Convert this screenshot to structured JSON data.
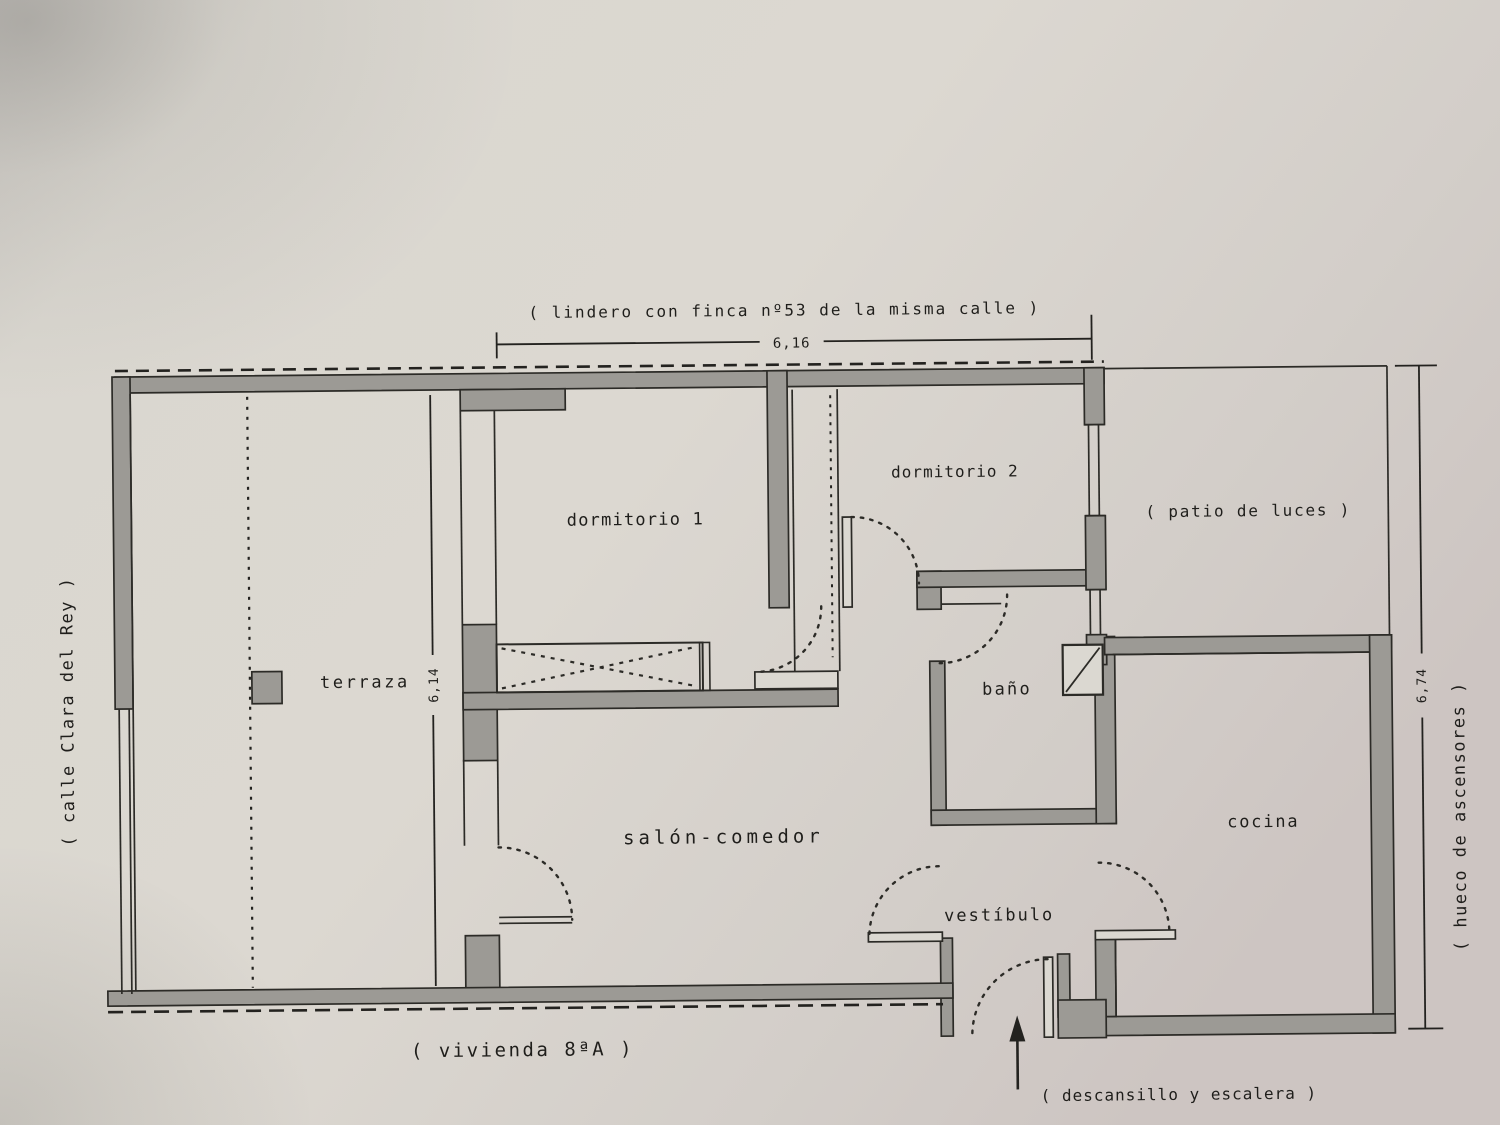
{
  "document_type": "scanned architectural floor plan",
  "labels": {
    "boundary_top": "( lindero con finca nº53 de la misma calle )",
    "street_left": "( calle Clara del Rey )",
    "patio": "( patio de luces )",
    "elevator_shaft": "( hueco de ascensores )",
    "dwelling": "( vivienda 8ªA )",
    "landing": "( descansillo y escalera )"
  },
  "rooms": {
    "terraza": "terraza",
    "dormitorio1": "dormitorio 1",
    "dormitorio2": "dormitorio 2",
    "bano": "baño",
    "salon": "salón-comedor",
    "vestibulo": "vestíbulo",
    "cocina": "cocina"
  },
  "dimensions": {
    "top_width": "6,16",
    "terraza_depth": "6,14",
    "right_height": "6,74"
  },
  "colors": {
    "paper": "#d9d6cf",
    "wall_fill": "#9c9a95",
    "line": "#2c2b27"
  }
}
